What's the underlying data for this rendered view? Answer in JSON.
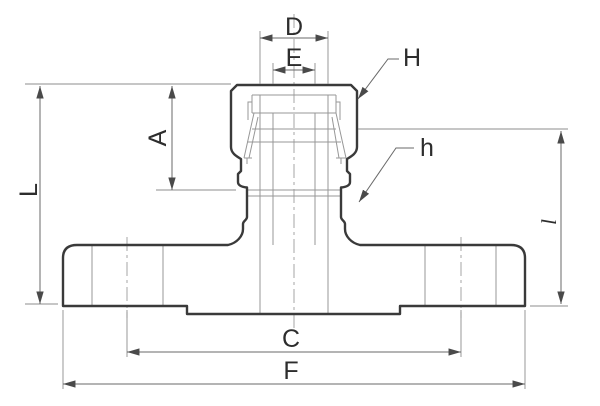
{
  "drawing": {
    "description": "Technical cross-section drawing of a flanged valve / fitting with dimension callouts",
    "labels": {
      "D": "D",
      "E": "E",
      "H": "H",
      "h": "h",
      "A": "A",
      "L": "L",
      "l": "l",
      "C": "C",
      "F": "F"
    },
    "colors": {
      "background": "#ffffff",
      "outline": "#3a3a3a",
      "thin_line": "#979797",
      "dimension_line": "#6a6a6a",
      "label_text": "#2d2d2d"
    }
  }
}
